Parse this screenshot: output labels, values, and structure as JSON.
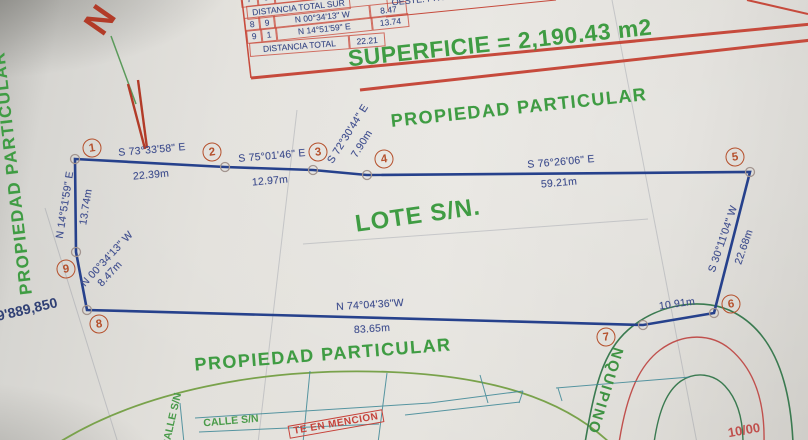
{
  "colors": {
    "boundary_navy": "#26418c",
    "vertex_red": "#b5502c",
    "annotation_green": "#3f9c43",
    "table_red": "#c64a3c",
    "road_green": "#3a7a50",
    "street_teal": "#3d8796",
    "label_navy": "#3f4e8e"
  },
  "north": {
    "label": "N"
  },
  "table": {
    "partial_row": {
      "col_a": "7",
      "col_b": "8"
    },
    "row_sur": {
      "label": "DISTANCIA TOTAL SUR"
    },
    "row_8_9": {
      "from": "8",
      "to": "9",
      "bearing": "N 00°34'13\" W",
      "distance": "8.47"
    },
    "row_9_1": {
      "from": "9",
      "to": "1",
      "bearing": "N 14°51'59\" E",
      "distance": "13.74"
    },
    "row_oeste": {
      "label": "DISTANCIA TOTAL OESTE",
      "value": "22.21"
    },
    "side_note": "OESTE: PROP.",
    "superficie": "SUPERFICIE = 2,190.43 m2"
  },
  "parcel": {
    "name": "LOTE S/N.",
    "vertices": [
      "1",
      "2",
      "3",
      "4",
      "5",
      "6",
      "7",
      "8",
      "9"
    ],
    "segments": [
      {
        "from": "1",
        "to": "2",
        "bearing": "S 73°33'58\" E",
        "distance": "22.39m"
      },
      {
        "from": "2",
        "to": "3",
        "bearing": "S 75°01'46\" E",
        "distance": "12.97m"
      },
      {
        "from": "3",
        "to": "4",
        "bearing": "S 72°30'44\" E",
        "distance": "7.90m"
      },
      {
        "from": "4",
        "to": "5",
        "bearing": "S 76°26'06\" E",
        "distance": "59.21m"
      },
      {
        "from": "5",
        "to": "6",
        "bearing": "S 30°11'04\" W",
        "distance": "22.68m"
      },
      {
        "from": "6",
        "to": "7",
        "distance": "10.91m"
      },
      {
        "from": "7",
        "to": "8",
        "bearing": "N 74°04'36\"W",
        "distance": "83.65m"
      },
      {
        "from": "8",
        "to": "9",
        "bearing": "N 00°34'13\" W",
        "distance": "8.47m"
      },
      {
        "from": "9",
        "to": "1",
        "bearing": "N 14°51'59\" E",
        "distance": "13.74m"
      }
    ]
  },
  "surroundings": {
    "propiedad_top": "PROPIEDAD PARTICULAR",
    "propiedad_left": "PROPIEDAD PARTICULAR",
    "propiedad_bottom": "PROPIEDAD PARTICULAR",
    "grid_coordinate": "9'889,850",
    "road_name": "NQUIPINO",
    "calle_label": "CALLE S/N",
    "calle_label_vertical": "CALLE S/N",
    "mencion_label": "TE EN MENCION",
    "road_station": "10/00"
  }
}
